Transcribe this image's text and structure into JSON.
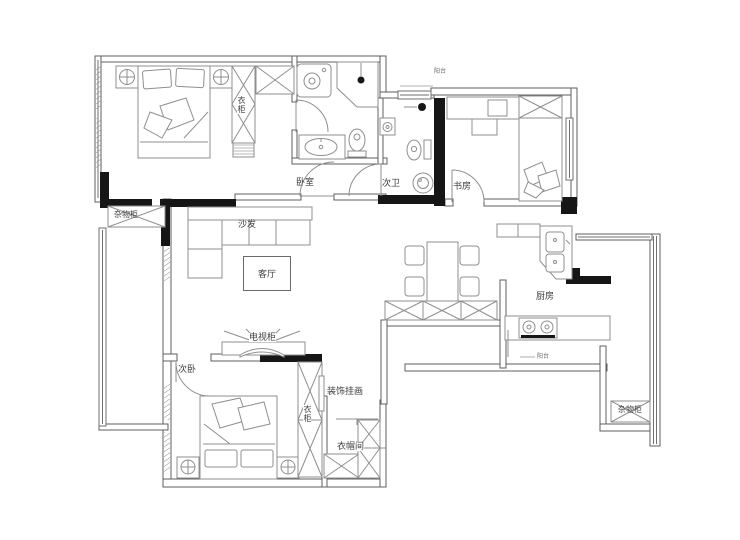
{
  "rooms": {
    "master_bedroom": "卧室",
    "second_bathroom": "次卫",
    "study": "书房",
    "living_room": "客厅",
    "kitchen": "厨房",
    "second_bedroom": "次卧",
    "cloakroom": "衣帽间",
    "balcony_top": "阳台",
    "balcony_bottom": "阳台"
  },
  "furniture": {
    "sofa": "沙发",
    "tv_cabinet": "电视柜",
    "wardrobe_master": "衣柜",
    "wardrobe_second": "衣柜",
    "decorative_painting": "装饰挂画",
    "storage_cabinet_left": "杂物柜",
    "storage_cabinet_right": "杂物柜"
  },
  "colors": {
    "wall_black": "#161616",
    "wall_line": "#5f5f5f",
    "furniture_line": "#8f8f8f",
    "text": "#3c3c3c",
    "background": "#ffffff"
  }
}
